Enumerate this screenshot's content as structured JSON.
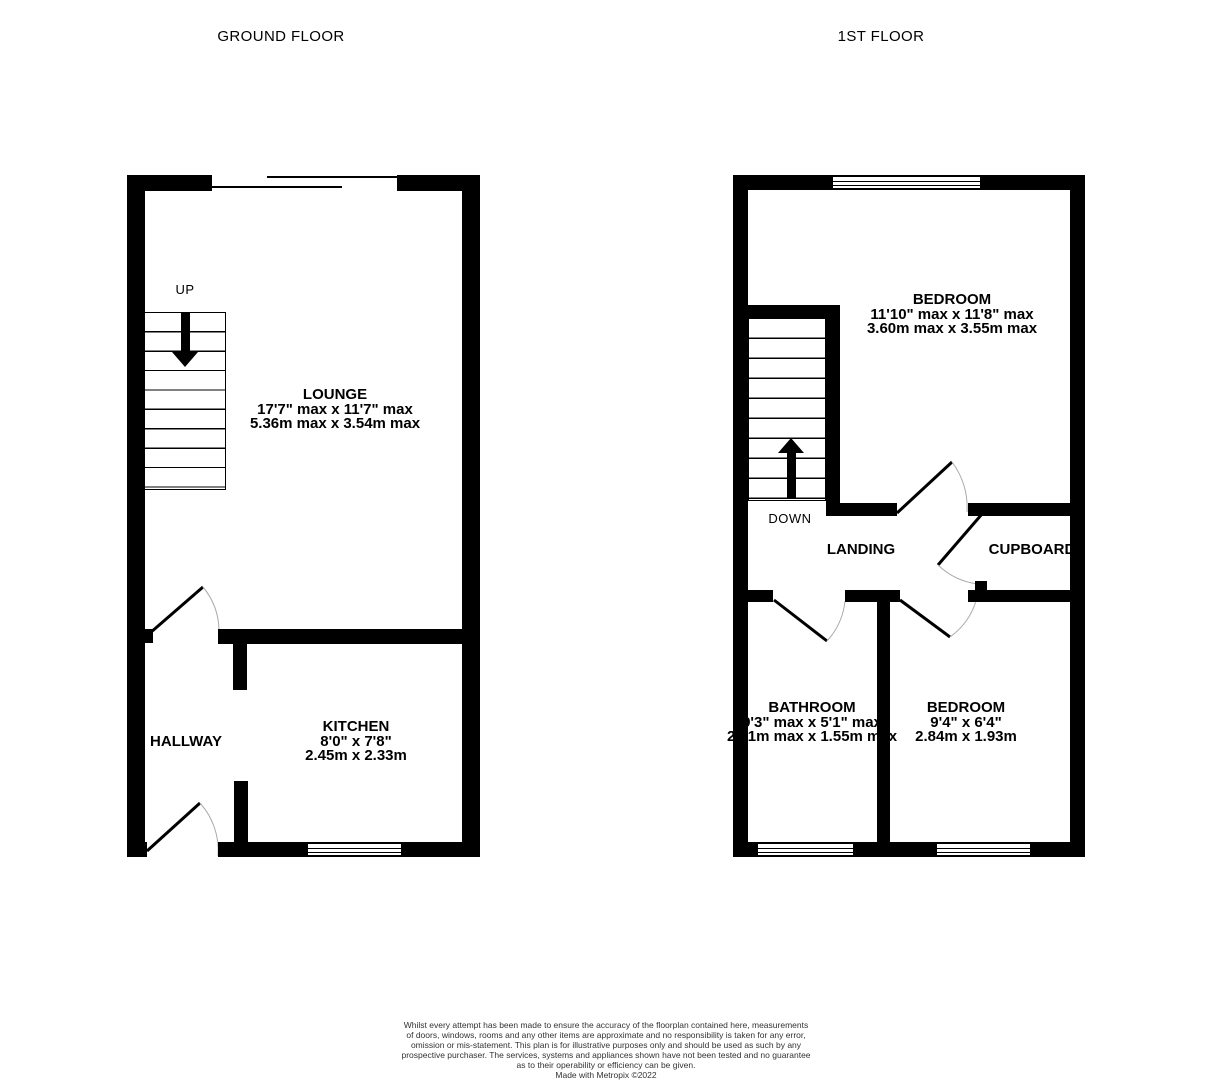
{
  "titles": {
    "ground": "GROUND FLOOR",
    "first": "1ST FLOOR"
  },
  "colors": {
    "wall": "#000000",
    "background": "#ffffff",
    "door_arc": "#aaaaaa"
  },
  "ground_floor": {
    "stair_direction": "UP",
    "rooms": {
      "lounge": {
        "name": "LOUNGE",
        "imperial": "17'7\" max x 11'7\" max",
        "metric": "5.36m max x 3.54m max"
      },
      "kitchen": {
        "name": "KITCHEN",
        "imperial": "8'0\"  x 7'8\"",
        "metric": "2.45m  x 2.33m"
      },
      "hallway": {
        "name": "HALLWAY"
      }
    }
  },
  "first_floor": {
    "stair_direction": "DOWN",
    "rooms": {
      "bedroom1": {
        "name": "BEDROOM",
        "imperial": "11'10\" max x 11'8\" max",
        "metric": "3.60m max x 3.55m max"
      },
      "bathroom": {
        "name": "BATHROOM",
        "imperial": "9'3\" max x 5'1\" max",
        "metric": "2.81m max x 1.55m max"
      },
      "bedroom2": {
        "name": "BEDROOM",
        "imperial": "9'4\"  x 6'4\"",
        "metric": "2.84m  x 1.93m"
      },
      "landing": {
        "name": "LANDING"
      },
      "cupboard": {
        "name": "CUPBOARD"
      }
    }
  },
  "disclaimer": {
    "lines": [
      "Whilst every attempt has been made to ensure the accuracy of the floorplan contained here, measurements",
      "of doors, windows, rooms and any other items are approximate and no responsibility is taken for any error,",
      "omission or mis-statement. This plan is for illustrative purposes only and should be used as such by any",
      "prospective purchaser. The services, systems and appliances shown have not been tested and no guarantee",
      "as to their operability or efficiency can be given.",
      "Made with Metropix ©2022"
    ]
  }
}
